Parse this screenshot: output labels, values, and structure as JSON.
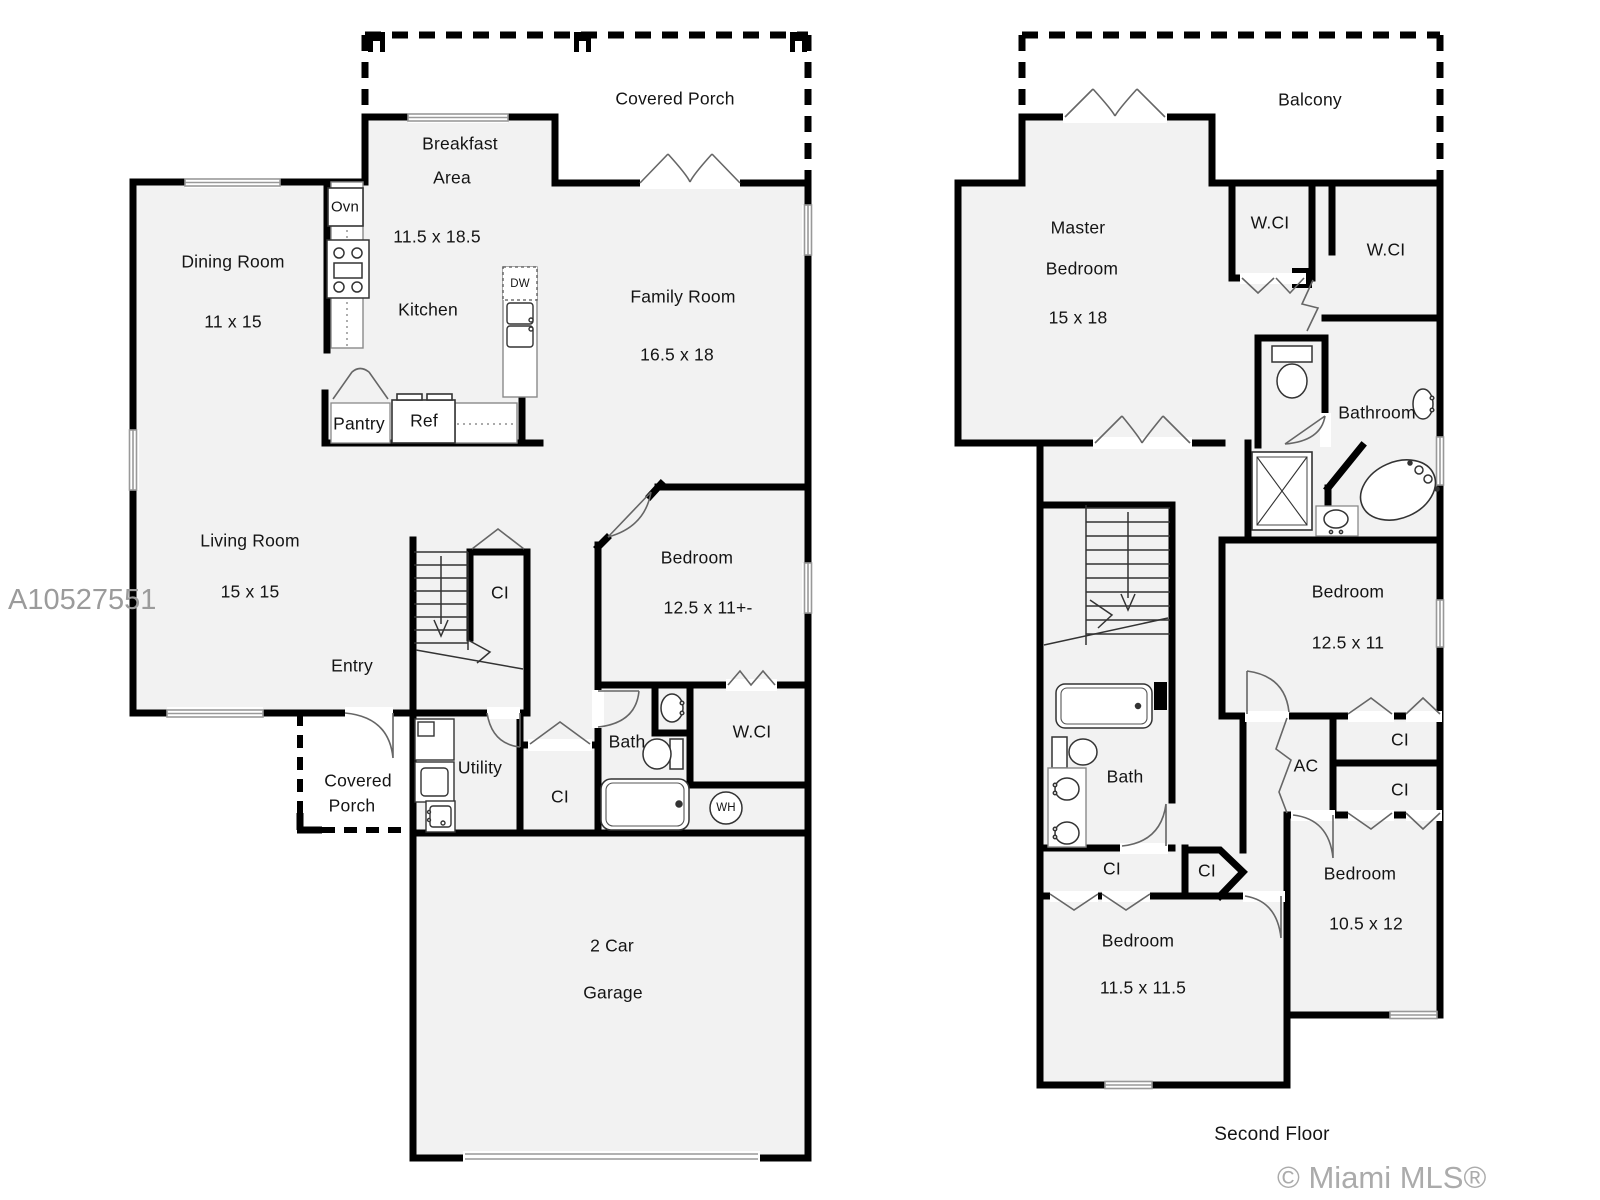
{
  "colors": {
    "wall": "#000000",
    "floor_fill": "#f2f2f2",
    "watermark": "#9b9b9b",
    "fixture": "#444444"
  },
  "watermarks": {
    "listing_id": "A10527551",
    "copyright": "© Miami MLS® 08/2018"
  },
  "floor2_caption": "Second Floor",
  "floor1": {
    "covered_porch_rear": "Covered Porch",
    "breakfast_1": "Breakfast",
    "breakfast_2": "Area",
    "breakfast_dims": "11.5 x 18.5",
    "dining": "Dining Room",
    "dining_dims": "11 x 15",
    "kitchen": "Kitchen",
    "family": "Family Room",
    "family_dims": "16.5 x 18",
    "living": "Living Room",
    "living_dims": "15 x 15",
    "entry": "Entry",
    "stair_closet": "CI",
    "bedroom": "Bedroom",
    "bedroom_dims": "12.5 x 11+-",
    "bath": "Bath",
    "wci": "W.CI",
    "water_heater": "WH",
    "utility": "Utility",
    "hall_closet": "CI",
    "covered_porch_front_1": "Covered",
    "covered_porch_front_2": "Porch",
    "garage_1": "2 Car",
    "garage_2": "Garage",
    "oven": "Ovn",
    "dishwasher": "DW",
    "fridge": "Ref",
    "pantry": "Pantry"
  },
  "floor2": {
    "balcony": "Balcony",
    "master_1": "Master",
    "master_2": "Bedroom",
    "master_dims": "15 x 18",
    "wci_a": "W.CI",
    "wci_b": "W.CI",
    "bathroom": "Bathroom",
    "bedroom_a": "Bedroom",
    "bedroom_a_dims": "12.5 x 11",
    "ac": "AC",
    "ci_top": "CI",
    "ci_bottom": "CI",
    "bath": "Bath",
    "ci_hall": "CI",
    "ci_pent": "CI",
    "bedroom_b": "Bedroom",
    "bedroom_b_dims": "11.5 x 11.5",
    "bedroom_c": "Bedroom",
    "bedroom_c_dims": "10.5 x 12"
  }
}
